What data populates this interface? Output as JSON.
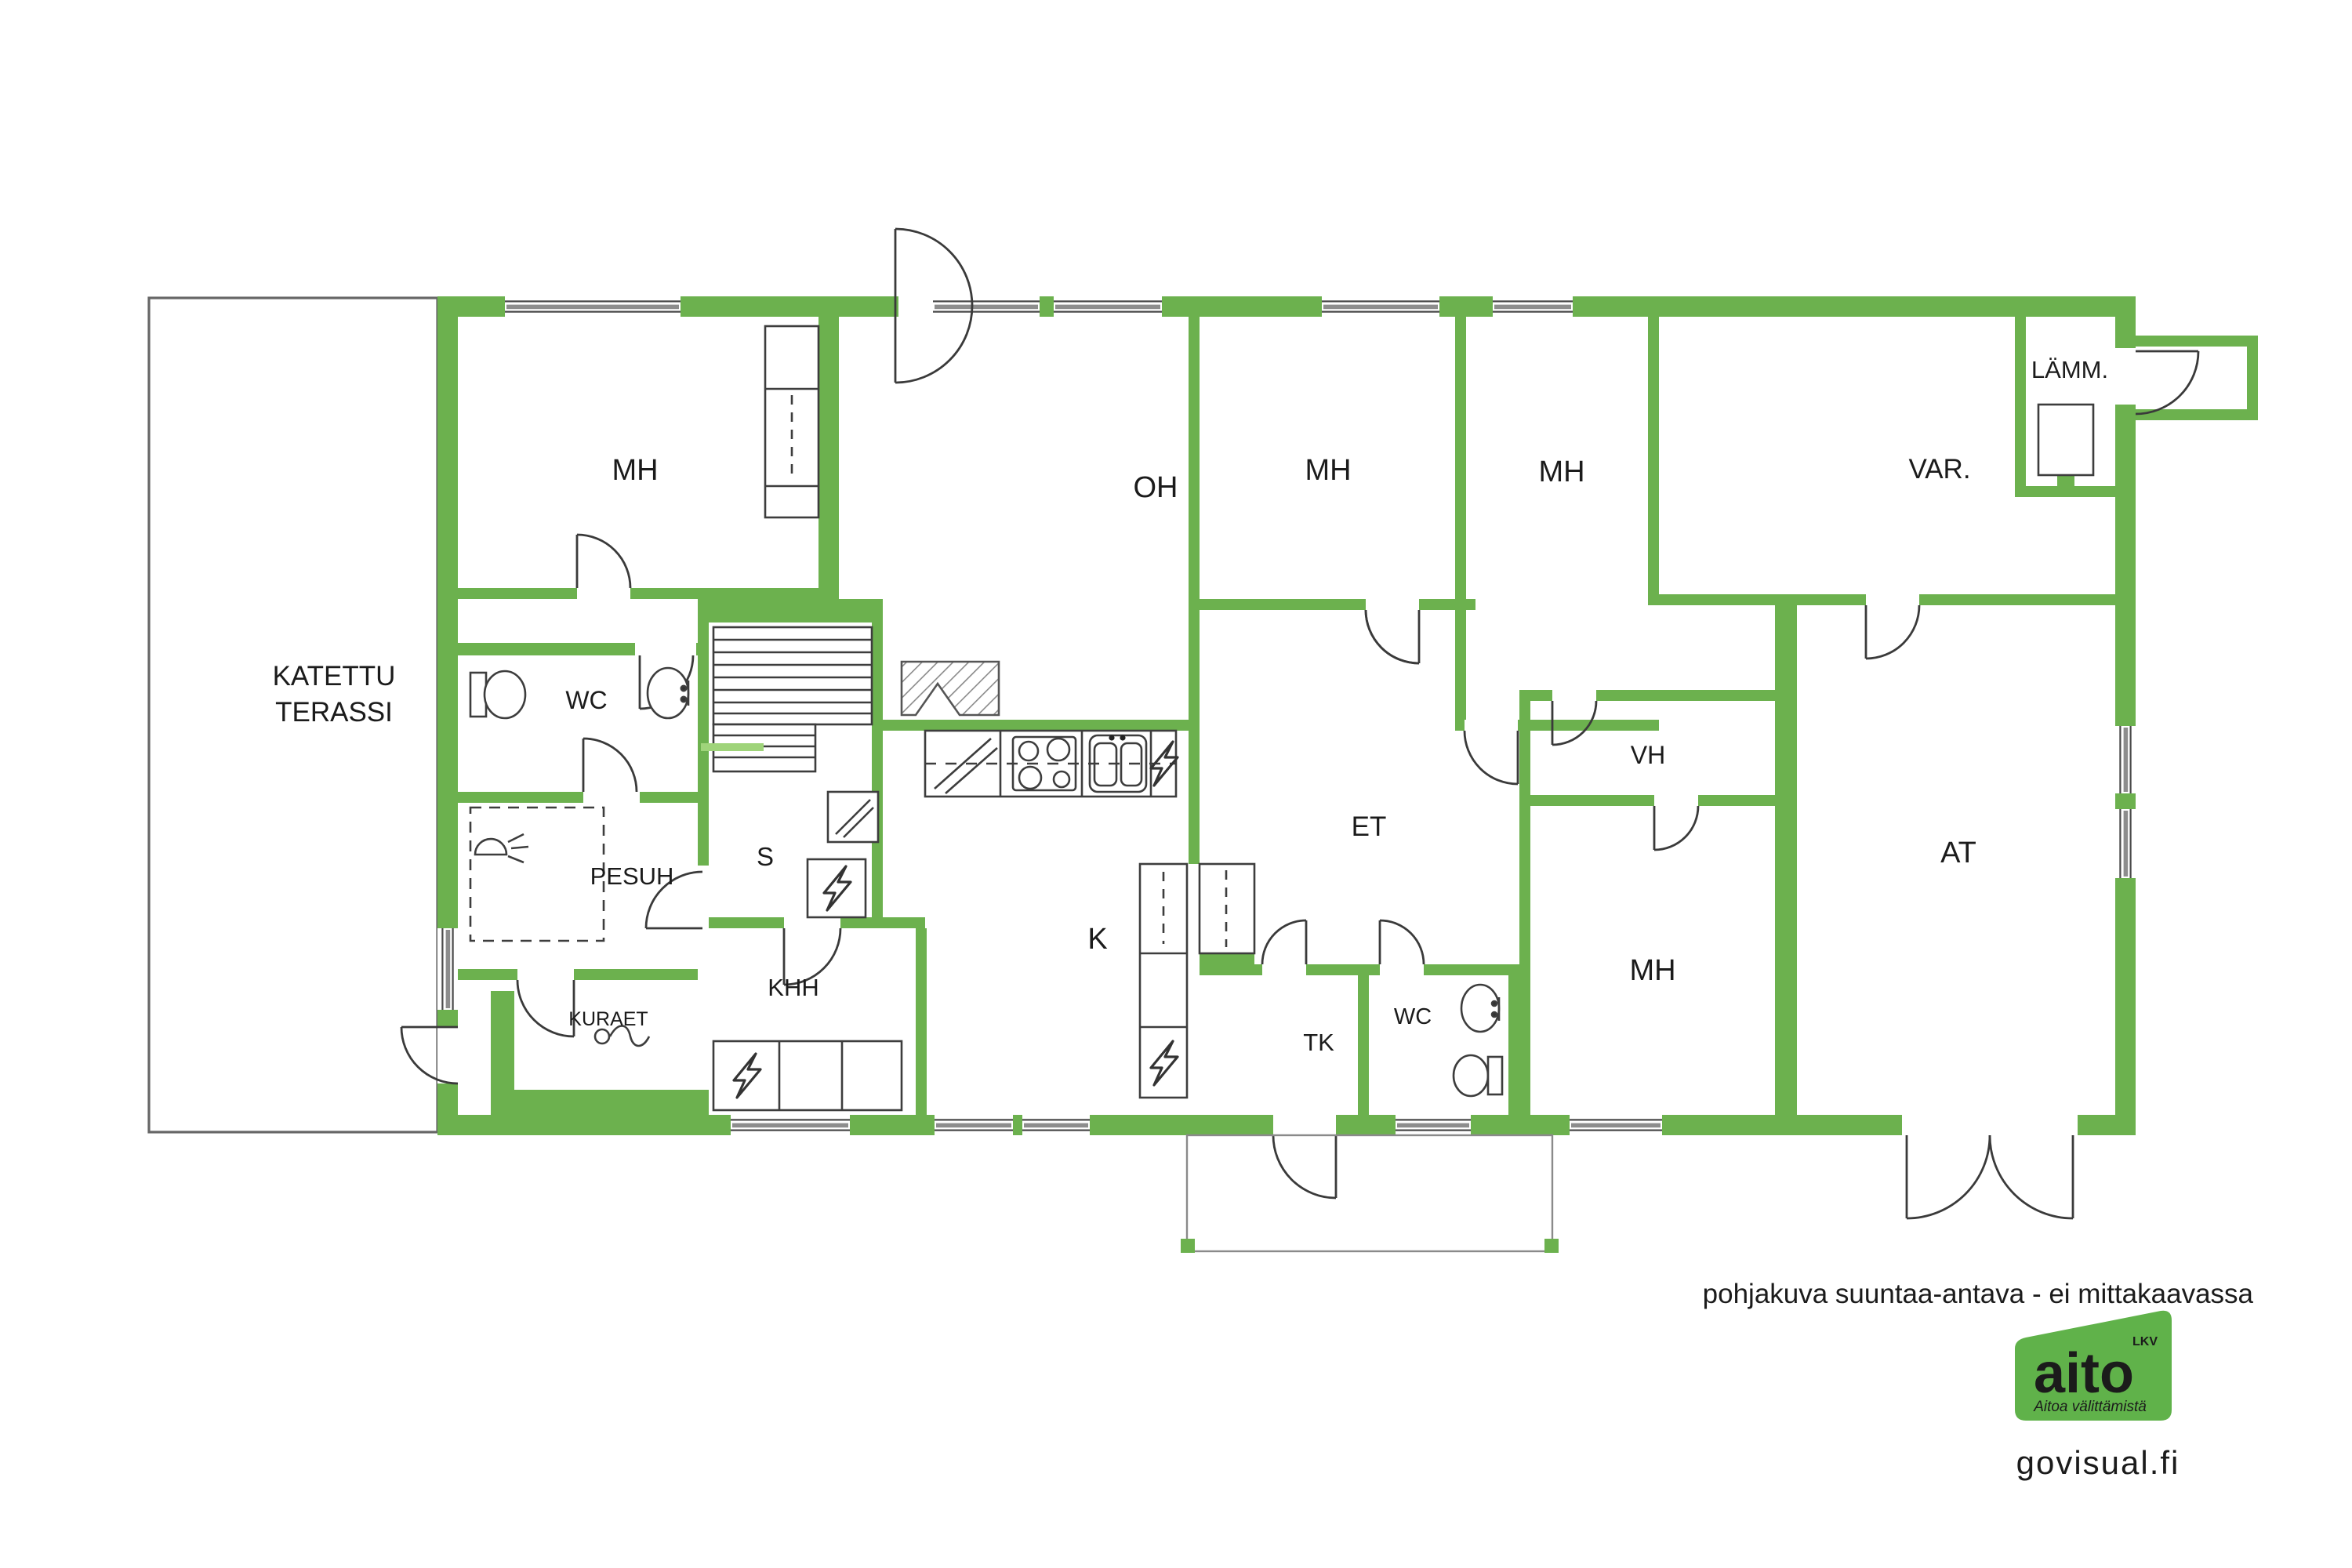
{
  "colors": {
    "wall_green": "#6cb14e",
    "glass_green": "#9fd47a",
    "outline": "#4a4a4a",
    "window_band": "#8d8d8d",
    "footer_text": "#9c9c9c",
    "watermark_text": "#b9b9b9",
    "logo_green": "#60b24a"
  },
  "rooms": {
    "terrace": {
      "line1": "KATETTU",
      "line2": "TERASSI"
    },
    "mh1": {
      "label": "MH"
    },
    "oh": {
      "label": "OH"
    },
    "mh2": {
      "label": "MH"
    },
    "mh3": {
      "label": "MH"
    },
    "var": {
      "label": "VAR."
    },
    "lamm": {
      "label": "LÄMM."
    },
    "wc1": {
      "label": "WC"
    },
    "s": {
      "label": "S"
    },
    "pesuh": {
      "label": "PESUH"
    },
    "kuraet": {
      "label": "KURAET"
    },
    "khh": {
      "label": "KHH"
    },
    "k": {
      "label": "K"
    },
    "et": {
      "label": "ET"
    },
    "tk": {
      "label": "TK"
    },
    "wc2": {
      "label": "WC"
    },
    "vh": {
      "label": "VH"
    },
    "mh4": {
      "label": "MH"
    },
    "at": {
      "label": "AT"
    }
  },
  "footer": {
    "disclaimer": "pohjakuva suuntaa-antava - ei mittakaavassa",
    "watermark": "govisual.fi"
  },
  "logo": {
    "brand": "aito",
    "suffix": "LKV",
    "tagline": "Aitoa välittämistä"
  }
}
